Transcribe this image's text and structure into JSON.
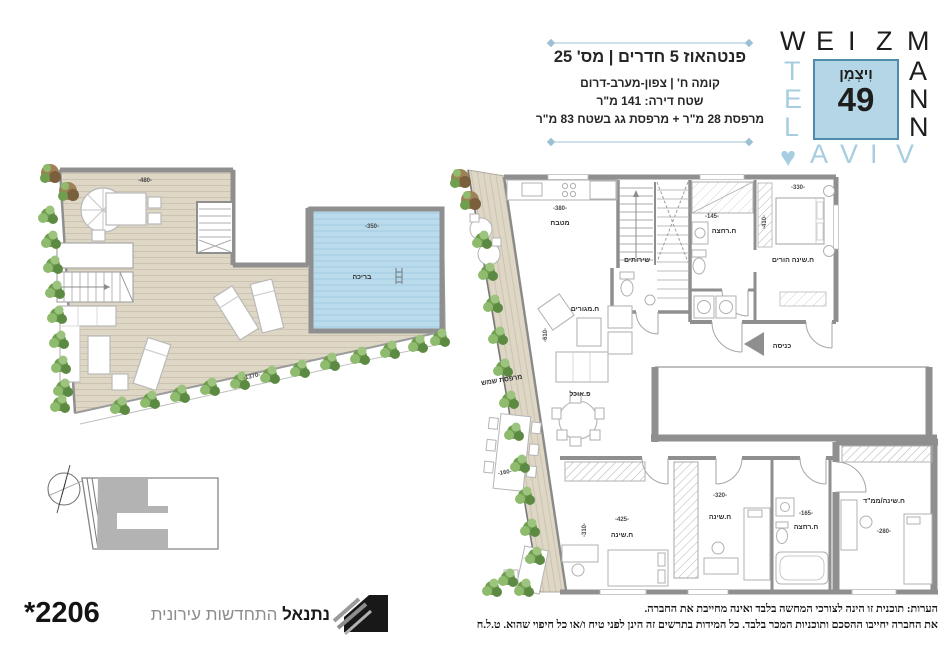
{
  "header": {
    "title": "פנטהאוז 5 חדרים | מס' 25",
    "subtitle": "קומה ח' | צפון-מערב-דרום",
    "area_line": "שטח דירה: 141 מ\"ר",
    "balcony_line": "מרפסת 28 מ\"ר + מרפסת גג בשטח 83 מ\"ר"
  },
  "logo": {
    "row_top": [
      "W",
      "E",
      "I",
      "Z",
      "M"
    ],
    "col_left": [
      "T",
      "E",
      "L"
    ],
    "col_right": [
      "A",
      "N",
      "N"
    ],
    "row_bottom": [
      "A",
      "V",
      "I",
      "V"
    ],
    "heart": "♥",
    "center_name": "וִיצְמָן",
    "center_number": "49"
  },
  "roof_plan": {
    "pool_label": "בריכה",
    "dim_top": "-480-",
    "dim_pool": "-350-",
    "dim_bottom": "-1370-"
  },
  "apartment_plan": {
    "balcony_label": "מרפסת שמש",
    "balcony_dim": "-160-",
    "kitchen_label": "מטבח",
    "kitchen_dim": "-380-",
    "living_label": "ח.מגורים",
    "living_dim": "-610-",
    "dining_label": "פ.אוכל",
    "wc_label": "שירותים",
    "master_bath_label": "ח.רחצה",
    "master_bath_dim": "-145-",
    "master_bed_label": "ח.שינה הורים",
    "master_bed_dim": "-330-",
    "master_bed_dim_v": "-410-",
    "entrance_label": "כניסה",
    "bedroom1_label": "ח.שינה",
    "bedroom1_dim": "-425-",
    "bedroom1_dim_v": "-310-",
    "bedroom2_label": "ח.שינה",
    "bedroom2_dim": "-320-",
    "bath2_label": "ח.רחצה",
    "bath2_dim": "-165-",
    "mamad_label": "ח.שינה/ממ\"ד",
    "mamad_dim": "-280-"
  },
  "footer": {
    "phone": "*2206",
    "brand_bold": "נתנאל",
    "brand_light": "התחדשות עירונית",
    "disclaimer_line1": "הערות: תוכנית זו הינה לצורכי המחשה בלבד ואינה מחייבת את החברה.",
    "disclaimer_line2": "את החברה יחייבו ההסכם ותוכניות המכר בלבד. כל המידות בתרשים זה הינן לפני טיח ו/או כל חיפוי שהוא. ט.ל.ח"
  },
  "colors": {
    "accent_blue": "#a7cde1",
    "pool_fill": "#b9dbec",
    "deck_fill": "#ded7c6",
    "wall_gray": "#8f8f8f"
  }
}
